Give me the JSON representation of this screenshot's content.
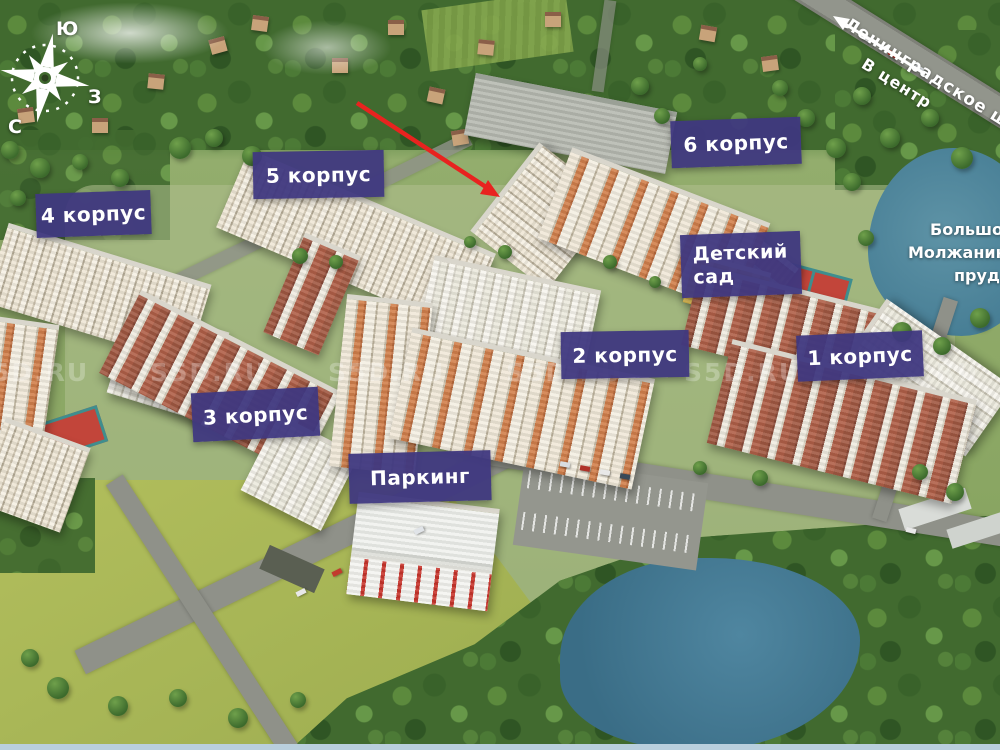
{
  "labels": [
    {
      "id": "korpus-4",
      "text": "4 корпус"
    },
    {
      "id": "korpus-5",
      "text": "5 корпус"
    },
    {
      "id": "korpus-6",
      "text": "6 корпус"
    },
    {
      "id": "detskiy-sad",
      "text": "Детский сад"
    },
    {
      "id": "korpus-2",
      "text": "2 корпус"
    },
    {
      "id": "korpus-1",
      "text": "1 корпус"
    },
    {
      "id": "korpus-3",
      "text": "3 корпус"
    },
    {
      "id": "parking",
      "text": "Паркинг"
    }
  ],
  "compass": {
    "south": "Ю",
    "west": "З",
    "north": "С"
  },
  "highway": {
    "name": "Ленинградское шоссе",
    "direction": "В центр"
  },
  "pond_label": {
    "lines": [
      "Большой",
      "Молжаниновский",
      "пруд"
    ]
  },
  "watermark": {
    "text": "S5D.RU"
  },
  "colors": {
    "label_bg": "#3f3880",
    "label_text": "#ffffff",
    "annotation_arrow": "#e8231f",
    "water": "#4f86a0",
    "meadow": "#a9b757",
    "forest": "#416a2f"
  }
}
